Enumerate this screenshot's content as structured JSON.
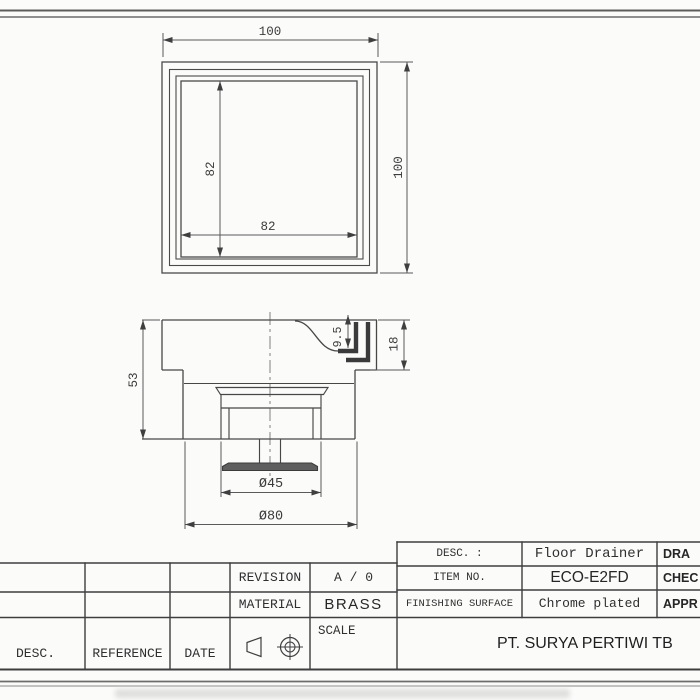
{
  "dimensions": {
    "top_view": {
      "outer_width": "100",
      "outer_height": "100",
      "inner_width": "82",
      "inner_height": "82"
    },
    "section_view": {
      "body_height": "53",
      "recess_depth": "9.5",
      "frame_height": "18",
      "strainer_dia": "Ø45",
      "outlet_dia": "Ø80"
    }
  },
  "title_block": {
    "desc_col_label": "DESC.",
    "reference_col_label": "REFERENCE",
    "date_col_label": "DATE",
    "revision_label": "REVISION",
    "revision_value": "A / 0",
    "material_label": "MATERIAL",
    "material_value": "BRASS",
    "scale_label": "SCALE",
    "desc_label": "DESC. :",
    "desc_value": "Floor Drainer",
    "item_label": "ITEM NO.",
    "item_value": "ECO-E2FD",
    "finish_label": "FINISHING SURFACE",
    "finish_value": "Chrome plated",
    "company": "PT. SURYA PERTIWI TB",
    "drawn_label": "DRA",
    "checked_label": "CHEC",
    "approved_label": "APPR"
  }
}
